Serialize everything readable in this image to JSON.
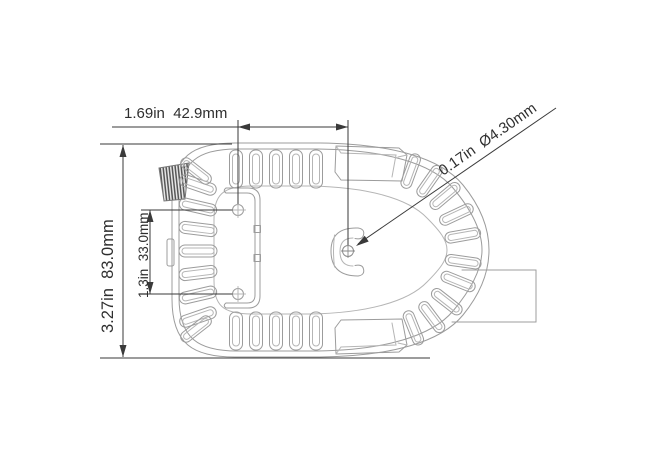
{
  "theme": {
    "bg": "#ffffff",
    "line-color": "#9c9c9c",
    "light-color": "#b5b5b5",
    "dim-color": "#3a3a3a",
    "text-color": "#2e2e2e"
  },
  "drawing": {
    "kind": "technical-dimension-drawing",
    "subject": "bilge-pump strainer base, top view",
    "dimensions": {
      "top_width": {
        "inches": "1.69in",
        "metric": "42.9mm",
        "label": "1.69in  42.9mm"
      },
      "hole_dia": {
        "inches": "0.17in",
        "metric": "Ø4.30mm",
        "label": "0.17in  Ø4.30mm"
      },
      "overall_height": {
        "inches": "3.27in",
        "metric": "83.0mm",
        "label": "3.27in  83.0mm"
      },
      "hole_spacing": {
        "inches": "1.3in",
        "metric": "33.0mm",
        "label": "1.3in  33.0mm"
      }
    }
  }
}
